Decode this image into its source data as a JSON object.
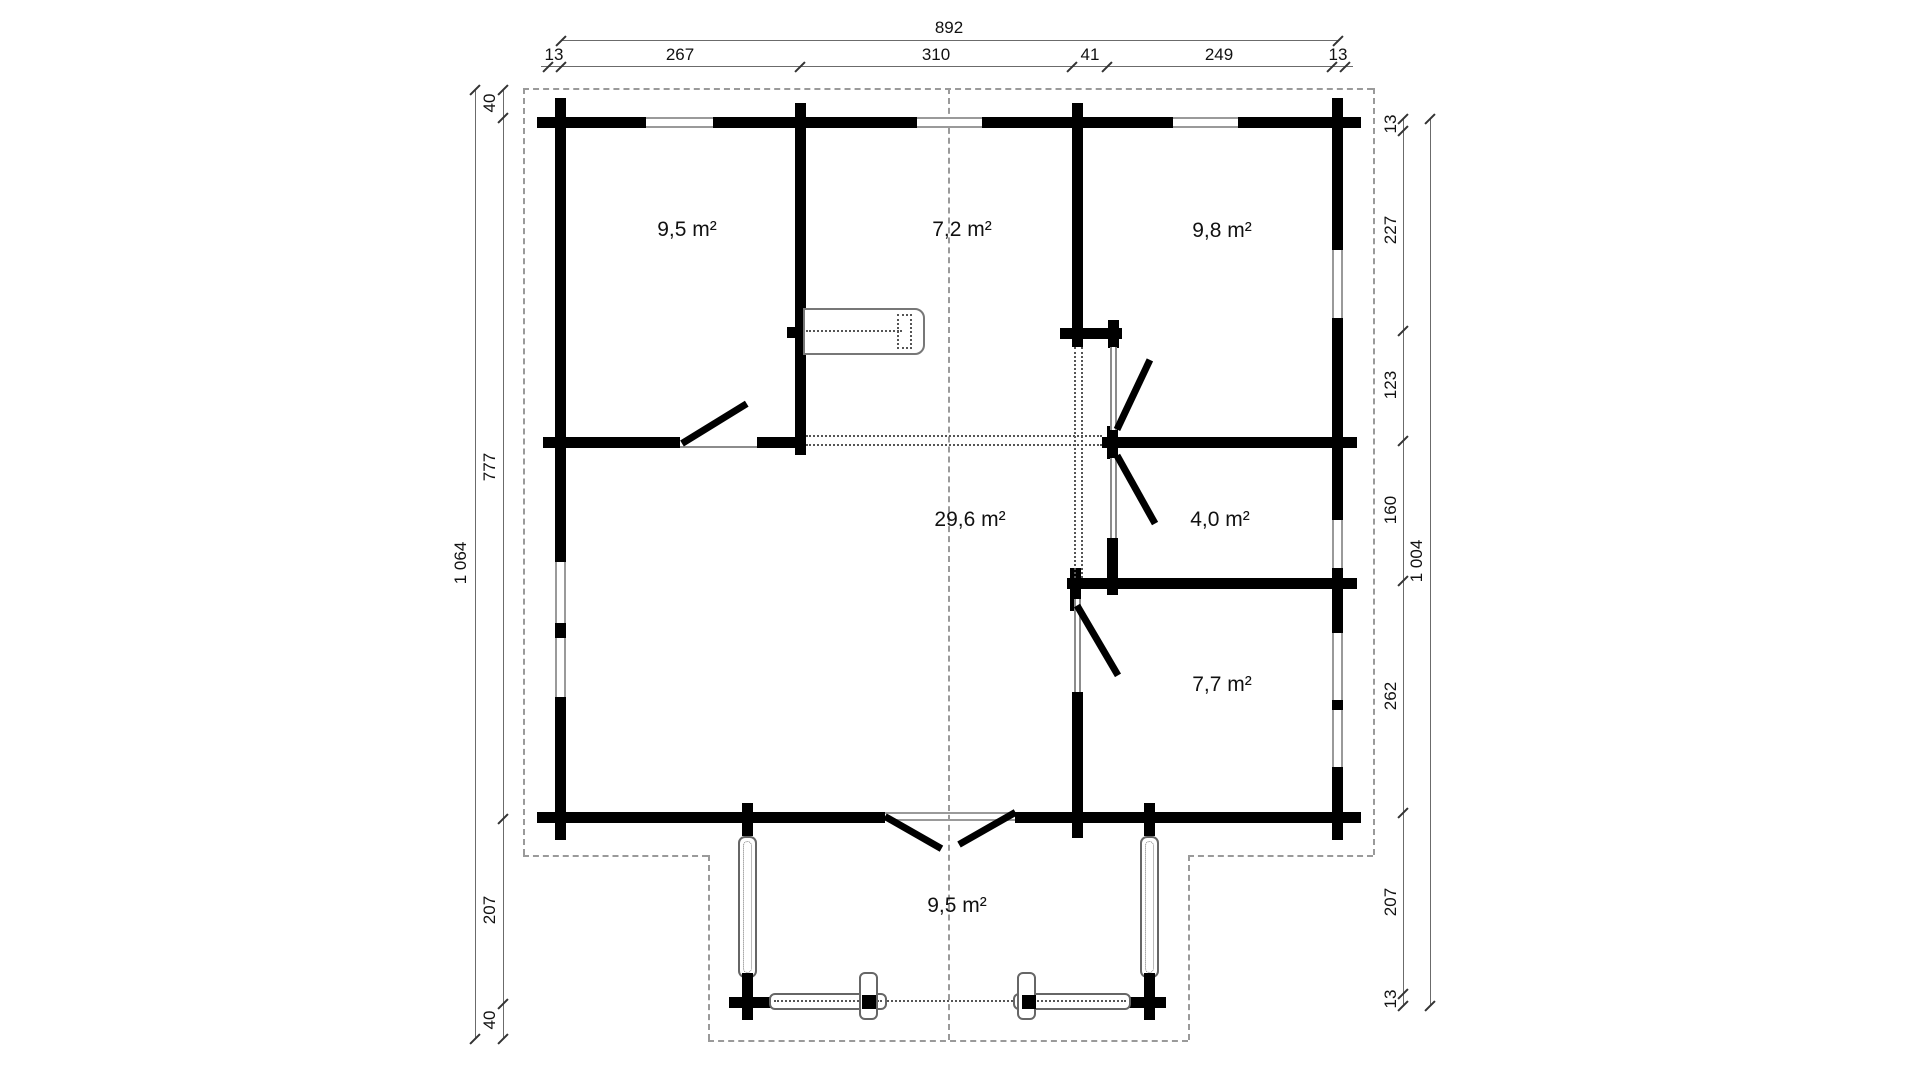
{
  "drawing": {
    "type": "floor-plan",
    "rooms": [
      {
        "id": "room-top-left",
        "area": "9,5 m²"
      },
      {
        "id": "room-top-middle",
        "area": "7,2 m²"
      },
      {
        "id": "room-top-right",
        "area": "9,8 m²"
      },
      {
        "id": "room-living",
        "area": "29,6 m²"
      },
      {
        "id": "room-small",
        "area": "4,0 m²"
      },
      {
        "id": "room-bottom-right",
        "area": "7,7 m²"
      },
      {
        "id": "porch",
        "area": "9,5 m²"
      }
    ],
    "dimensions": {
      "top": {
        "overall": "892",
        "segments": [
          "13",
          "267",
          "310",
          "41",
          "249",
          "13"
        ]
      },
      "left": {
        "overall": "1 064",
        "segments": [
          "40",
          "777",
          "207",
          "40"
        ]
      },
      "right": {
        "overall": "1 004",
        "segments": [
          "13",
          "227",
          "123",
          "160",
          "262",
          "207",
          "13"
        ]
      }
    },
    "colors": {
      "wall": "#000000",
      "thin_line": "#8c8c8c",
      "dashed_line": "#9a9a9a",
      "dotted_line": "#555555",
      "dimension_line": "#6b6b6b",
      "text": "#111111",
      "background": "#ffffff"
    }
  }
}
